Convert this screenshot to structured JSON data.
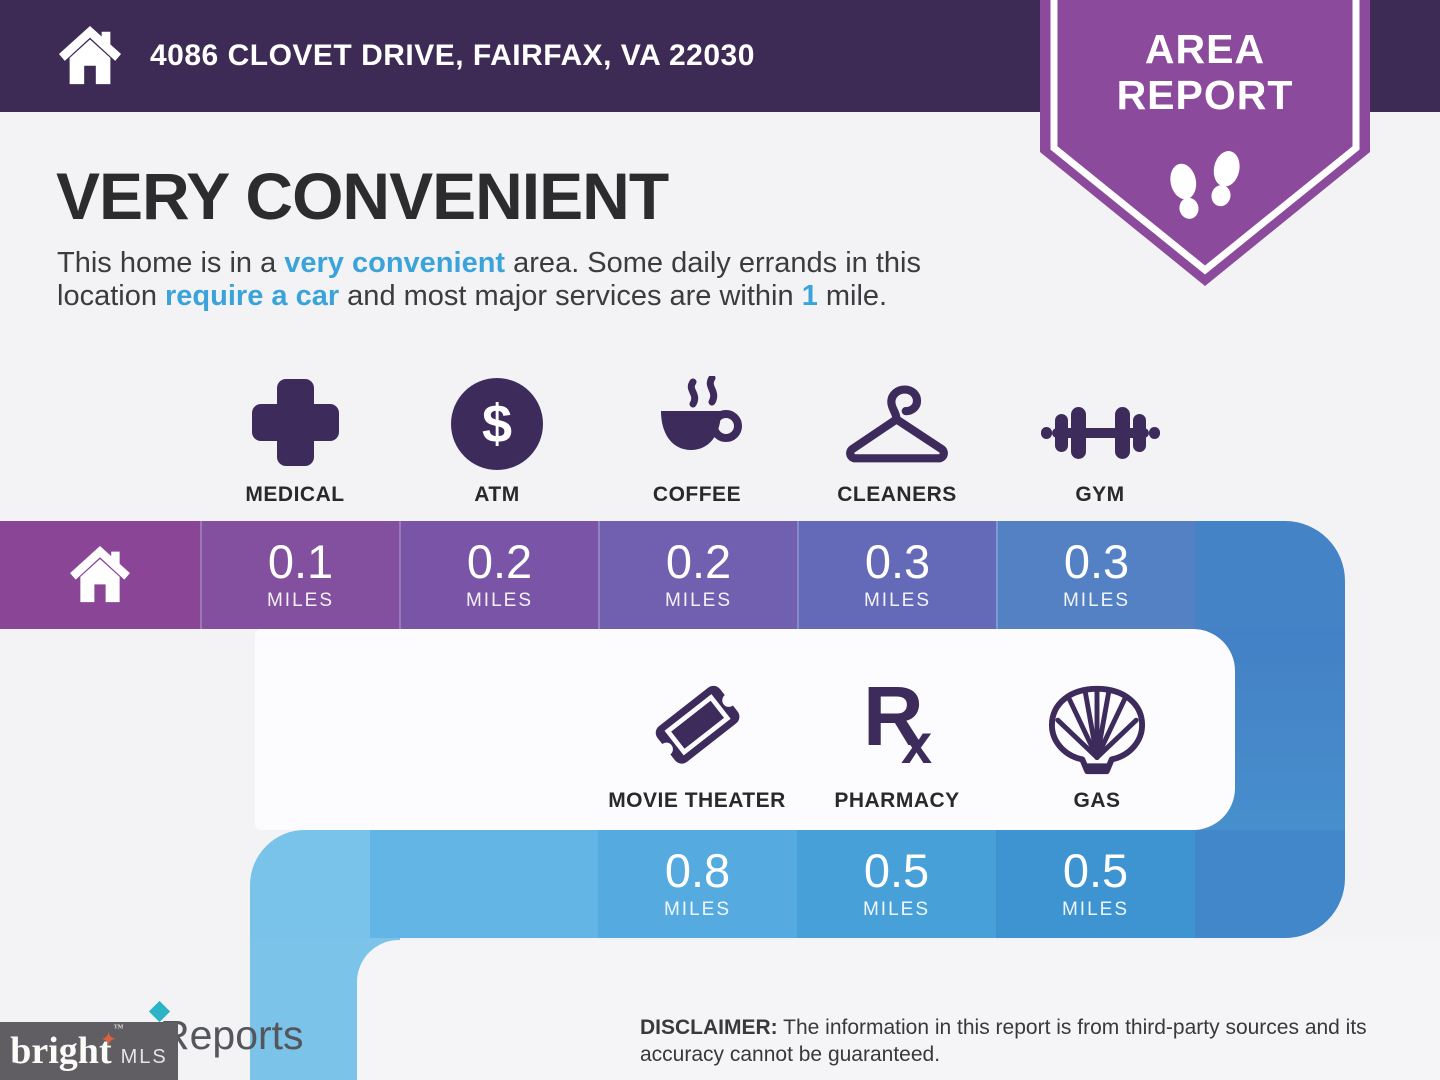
{
  "header": {
    "address": "4086 CLOVET DRIVE, FAIRFAX, VA 22030"
  },
  "badge": {
    "line1": "AREA",
    "line2": "REPORT"
  },
  "title": "VERY CONVENIENT",
  "summary": {
    "pre": "This home is in a ",
    "hl1": "very convenient",
    "mid1": " area. Some daily errands in this",
    "mid2": "location ",
    "hl2": "require a car",
    "mid3": " and most major services are within ",
    "hl3": "1",
    "post": " mile."
  },
  "row1": {
    "items": [
      {
        "label": "MEDICAL",
        "value": "0.1",
        "unit": "MILES"
      },
      {
        "label": "ATM",
        "value": "0.2",
        "unit": "MILES"
      },
      {
        "label": "COFFEE",
        "value": "0.2",
        "unit": "MILES"
      },
      {
        "label": "CLEANERS",
        "value": "0.3",
        "unit": "MILES"
      },
      {
        "label": "GYM",
        "value": "0.3",
        "unit": "MILES"
      }
    ]
  },
  "row2": {
    "items": [
      {
        "label": "MOVIE THEATER",
        "value": "0.8",
        "unit": "MILES"
      },
      {
        "label": "PHARMACY",
        "value": "0.5",
        "unit": "MILES"
      },
      {
        "label": "GAS",
        "value": "0.5",
        "unit": "MILES"
      }
    ]
  },
  "icons": {
    "atm_symbol": "$",
    "rx_r": "R",
    "rx_x": "x"
  },
  "footer": {
    "disclaimer_label": "DISCLAIMER:",
    "disclaimer_text": " The information in this report is from third-party sources and its accuracy cannot be guaranteed.",
    "partial_text": "Reports",
    "logo_text": "bright",
    "logo_star": "✦",
    "logo_tm": "™",
    "logo_mls": "MLS"
  },
  "colors": {
    "header_bg": "#3d2b55",
    "badge": "#8b4a9c",
    "accent_blue": "#3aa4da",
    "icon_purple": "#3d2b5c",
    "row1_home": "#8b4596",
    "row1": [
      "#82509f",
      "#7a55a7",
      "#7160af",
      "#646ab7",
      "#5480c4"
    ],
    "row1_connector": "#4583c7",
    "row2_lead1": "#79c2ea",
    "row2_lead2": "#63b5e5",
    "row2": [
      "#55abdf",
      "#47a0d8",
      "#3e94d0"
    ],
    "row2_connector": "#4187c9",
    "rcol_top": "#4480c5",
    "rcol_bottom": "#478fcd",
    "lcol": "#7cc3ea"
  },
  "chart_data": {
    "type": "table",
    "title": "VERY CONVENIENT",
    "categories": [
      "MEDICAL",
      "ATM",
      "COFFEE",
      "CLEANERS",
      "GYM",
      "MOVIE THEATER",
      "PHARMACY",
      "GAS"
    ],
    "values": [
      0.1,
      0.2,
      0.2,
      0.3,
      0.3,
      0.8,
      0.5,
      0.5
    ],
    "unit": "miles",
    "legend_position": "none",
    "grid": false
  }
}
